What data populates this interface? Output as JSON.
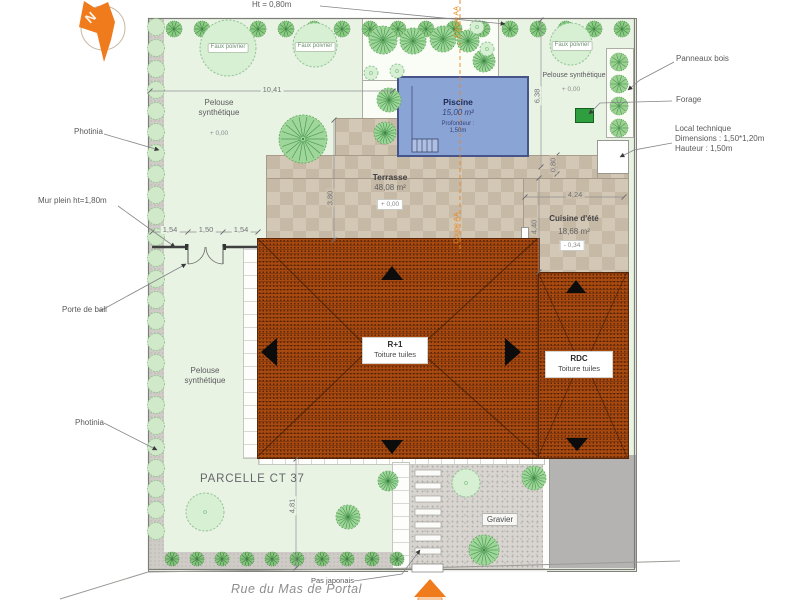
{
  "plan": {
    "north": "N",
    "hedge_height": "Ht = 0,80m",
    "coupe": "Coupe AA",
    "street": "Rue du Mas de Portal",
    "parcel": "PARCELLE CT 37"
  },
  "left_labels": {
    "photinia_top": "Photinia",
    "wall": "Mur plein ht=1,80m",
    "door": "Porte de bali",
    "photinia_bottom": "Photinia"
  },
  "right_labels": {
    "panels": "Panneaux bois",
    "borehole": "Forage",
    "tech_title": "Local technique",
    "tech_dimensions": "Dimensions : 1,50*1,20m",
    "tech_height": "Hauteur :  1,50m"
  },
  "bottom_labels": {
    "stepping": "Pas japonais"
  },
  "zones": {
    "pool": {
      "name": "Piscine",
      "area": "15,00 m²",
      "depth_label": "Profondeur :",
      "depth_value": "1,50m"
    },
    "terrace": {
      "name": "Terrasse",
      "area": "48,08 m²",
      "level": "+ 0,00"
    },
    "summer_kitchen": {
      "name": "Cuisine d'été",
      "area": "18,68 m²",
      "level": "- 0,34"
    },
    "upper_floor": {
      "name": "R+1",
      "roof": "Toiture tuiles"
    },
    "ground_floor": {
      "name": "RDC",
      "roof": "Toiture tuiles"
    },
    "gravel": {
      "name": "Gravier"
    },
    "lawn": {
      "name": "Pelouse synthétique",
      "level": "+ 0,00"
    },
    "tree_label": "Faux poivrier"
  },
  "dimensions": {
    "garden_width": "10,41",
    "garden_right": "6,38",
    "terrace_depth": "3,80",
    "kitchen_width": "4,24",
    "kitchen_depth": "4,40",
    "kitchen_offset": "0,80",
    "wall_segments": [
      "1,54",
      "1,50",
      "1,54"
    ],
    "south_gap": "4,81"
  },
  "colors": {
    "accent_orange": "#ef7b1d",
    "roof_red": "#a8490f",
    "pool_blue": "#8ba4d6",
    "lawn_green": "#e9f3e4",
    "forage_green": "#2f9e3f"
  }
}
